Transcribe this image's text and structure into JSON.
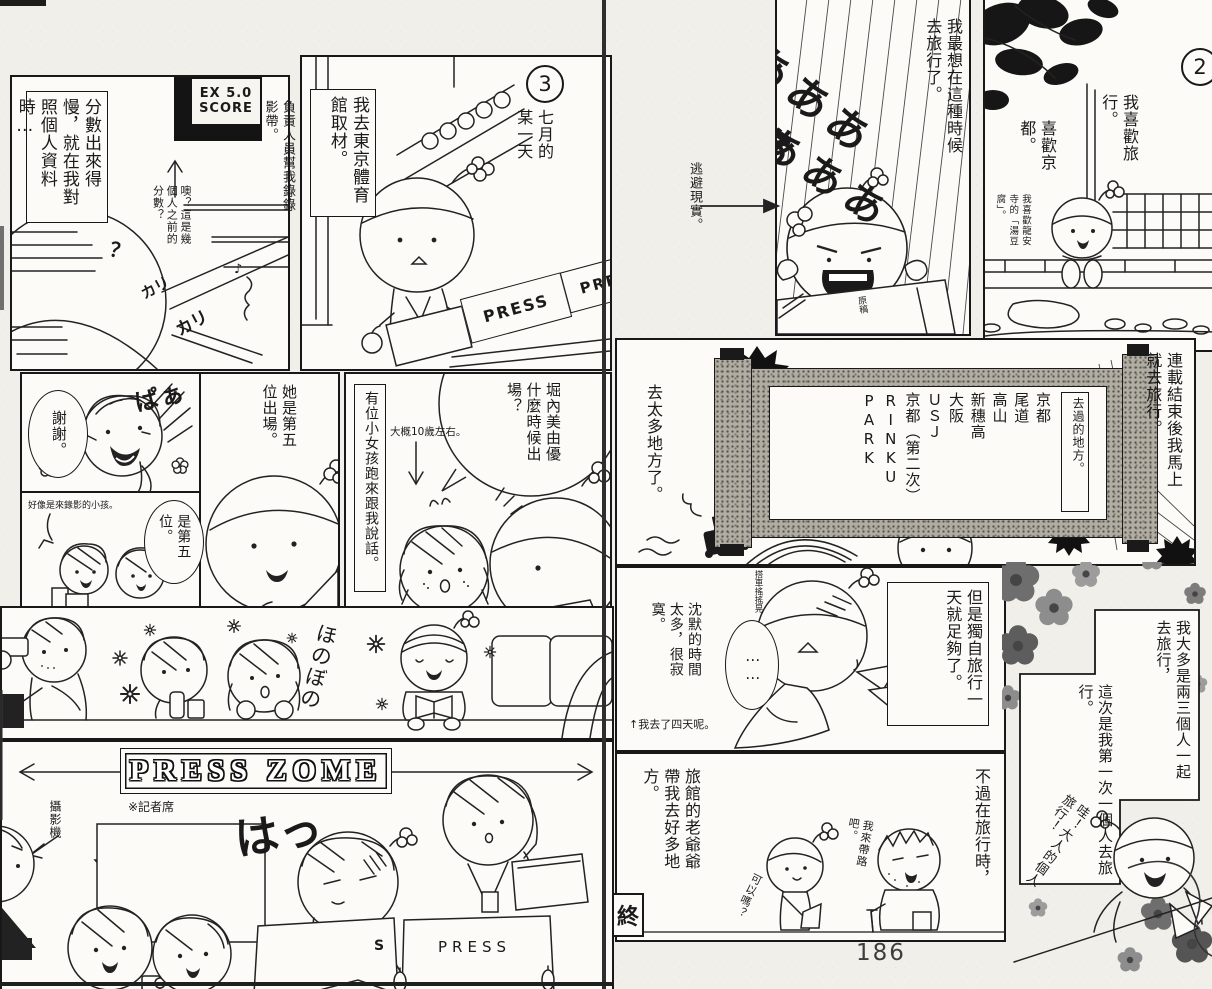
{
  "page": {
    "number": "186"
  },
  "left": {
    "p1": {
      "caption": "分數出來得慢，就在我對照個人資料時…",
      "board_label": "分數看板",
      "board_line1": "EX 5.0",
      "board_line2": "SCORE",
      "margin_note": "負責人員幫我錄錄影帶。",
      "small_note": "噢？這是幾個人之前的分數？",
      "sfx_scribble1": "カリ",
      "sfx_scribble2": "カリ",
      "question_mark": "？",
      "music_note": "♪"
    },
    "p2": {
      "number": "3",
      "caption": "七月的某一天",
      "speech": "我去東京體育館取材。",
      "press_sign1": "PRESS",
      "press_sign2": "PRE"
    },
    "p3": {
      "bubble_thanks": "謝謝。",
      "sfx_paa": "ぱぁ",
      "note_kids": "好像是來錄影的小孩。",
      "bubble_fifth": "是第五位。",
      "bubble_she": "她是第五位出場。"
    },
    "p4": {
      "caption": "有位小女孩跑來跟我說話。",
      "bubble": "堀內美由優什麼時候出場？",
      "note_age": "大概10歲左右。"
    },
    "p5": {
      "sfx_honobono": "ほのぼの"
    },
    "p6": {
      "banner": "PRESS ZOME",
      "banner_note": "※記者席",
      "camera_label": "攝影機",
      "sfx_ha": "はっ",
      "desk_sign": "PRESS",
      "desk_sign_partial": "S"
    }
  },
  "right": {
    "margin_note": "逃避現實。",
    "p1": {
      "speech": "我最想在這種時候去旅行了。",
      "sfx_scream_row1": "あああああ",
      "sfx_scream_row2": "あああ",
      "desk_label": "原稿"
    },
    "p2": {
      "number": "2",
      "speech1": "我喜歡旅行。",
      "speech2": "喜歡京都。",
      "note": "我喜歡龍安寺的「湯豆腐」。"
    },
    "p3": {
      "caption_right": "連載結束後我馬上就去旅行。",
      "caption_left": "去太多地方了。",
      "scroll_title": "去過的地方。",
      "places": [
        "京都",
        "尾道",
        "高山",
        "新穗高",
        "大阪",
        "ＵＳＪ",
        "京都（第二次）",
        "RINKU PARK"
      ]
    },
    "p4": {
      "caption": "但是獨自旅行一天就足夠了。",
      "left_text": "沈默的時間太多，很寂寞。",
      "foot_note": "↑我去了四天呢。",
      "bubble_dots": "……",
      "head_note": "搭車搖搖晃"
    },
    "sidebar": {
      "text1": "我大多是兩三個人一起去旅行，",
      "text2": "這次是我第一次一個人去旅行。",
      "speech_joy": "哇！大人的個人旅行！"
    },
    "p5": {
      "caption_right": "不過在旅行時，",
      "caption_left": "旅館的老爺爺帶我去好多地方。",
      "end_mark": "終",
      "speech_ok": "可以嗎？",
      "speech_guide": "我來帶路吧。"
    }
  }
}
